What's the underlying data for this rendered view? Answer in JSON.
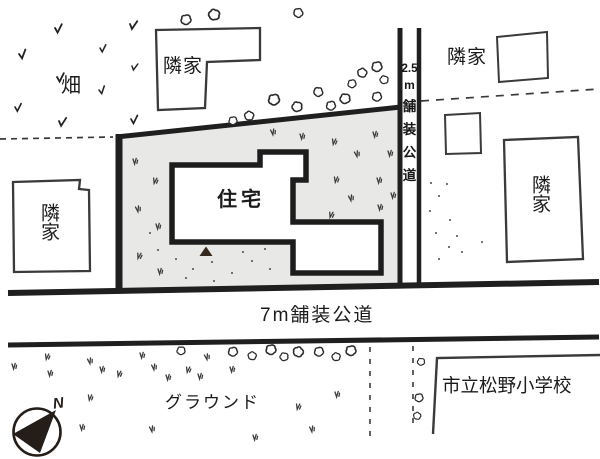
{
  "labels": {
    "field": "畑",
    "neighbor_top": "隣家",
    "neighbor_left": "隣家",
    "neighbor_top_right": "隣家",
    "neighbor_right": "隣家",
    "house": "住宅",
    "ground": "グラウンド",
    "school": "市立松野小学校"
  },
  "roads": {
    "side_road": {
      "label": "2.5m舗装公道",
      "segments": [
        "2.5",
        "m",
        "舗",
        "装",
        "公",
        "道"
      ]
    },
    "front_road": {
      "label": "7m舗装公道"
    }
  },
  "compass": {
    "north_label": "N"
  },
  "colors": {
    "ink": "#262626",
    "lot_fill": "#e8e8e6",
    "paper": "#ffffff"
  }
}
